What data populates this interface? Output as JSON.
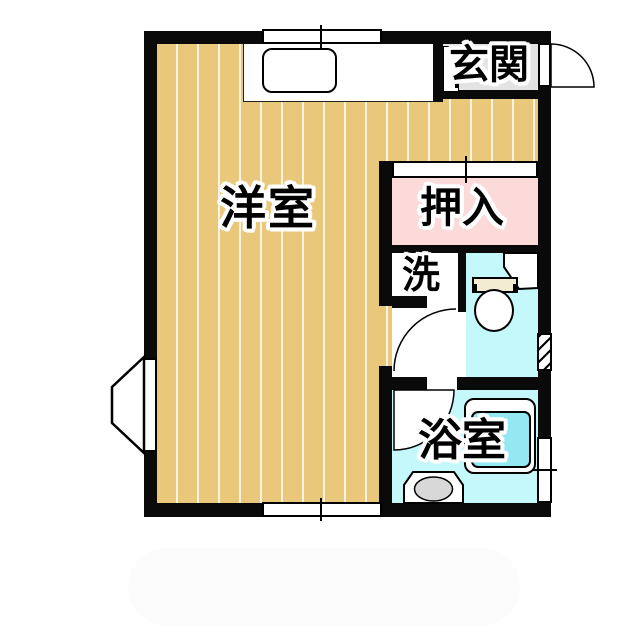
{
  "plan_type": "japanese-apartment-floor-plan",
  "rooms": {
    "genkan": {
      "label": "玄関"
    },
    "west_room": {
      "label": "洋室"
    },
    "oshiire": {
      "label": "押入"
    },
    "washroom": {
      "label": "洗"
    },
    "bathroom": {
      "label": "浴室"
    }
  },
  "fixtures": [
    "kitchen-counter",
    "kitchen-sink",
    "shoe-cabinet",
    "entrance-door",
    "sliding-closet-door",
    "toilet-tank",
    "toilet-bowl",
    "corner-shelf",
    "toilet-door",
    "bathroom-door",
    "bathtub",
    "wash-basin",
    "bay-window",
    "window-top",
    "window-bottom",
    "window-bathroom",
    "vent-hatch"
  ],
  "colors": {
    "wall": "#0a0a0a",
    "wood_floor": "#e9c87c",
    "floor_stripe": "#f7ecd2",
    "closet_pink": "#fcdada",
    "wet_room_cyan": "#c5f8fb",
    "tub_inner_cyan": "#93e8f1",
    "genkan_gray": "#e3e3e4",
    "toilet_tank_cream": "#f3ecd2",
    "basin_gray": "#d8d8d8"
  }
}
